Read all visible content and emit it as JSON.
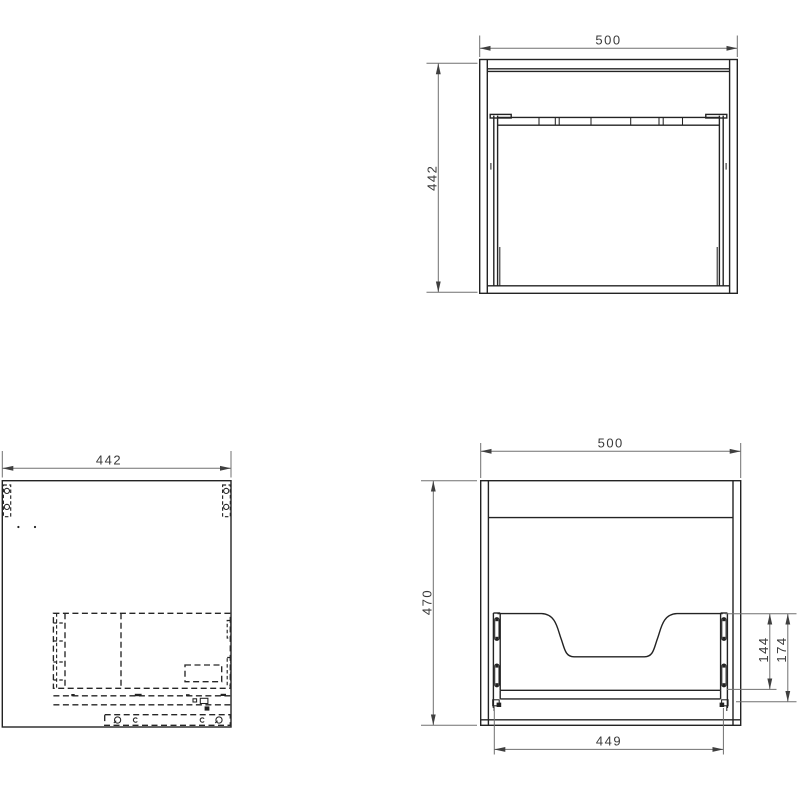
{
  "drawing": {
    "type": "furniture-cabinet-technical-drawing",
    "views": {
      "plan": {
        "width": "500",
        "depth": "442"
      },
      "side": {
        "depth": "442"
      },
      "rear": {
        "width": "500",
        "height": "470",
        "slide_span": "449",
        "dim_inner": "144",
        "dim_outer": "174"
      }
    },
    "colors": {
      "background": "#ffffff",
      "object_line": "#232323",
      "hidden_line": "#262626",
      "dimension_line": "#707070",
      "dimension_text": "#3a3a3a"
    }
  }
}
